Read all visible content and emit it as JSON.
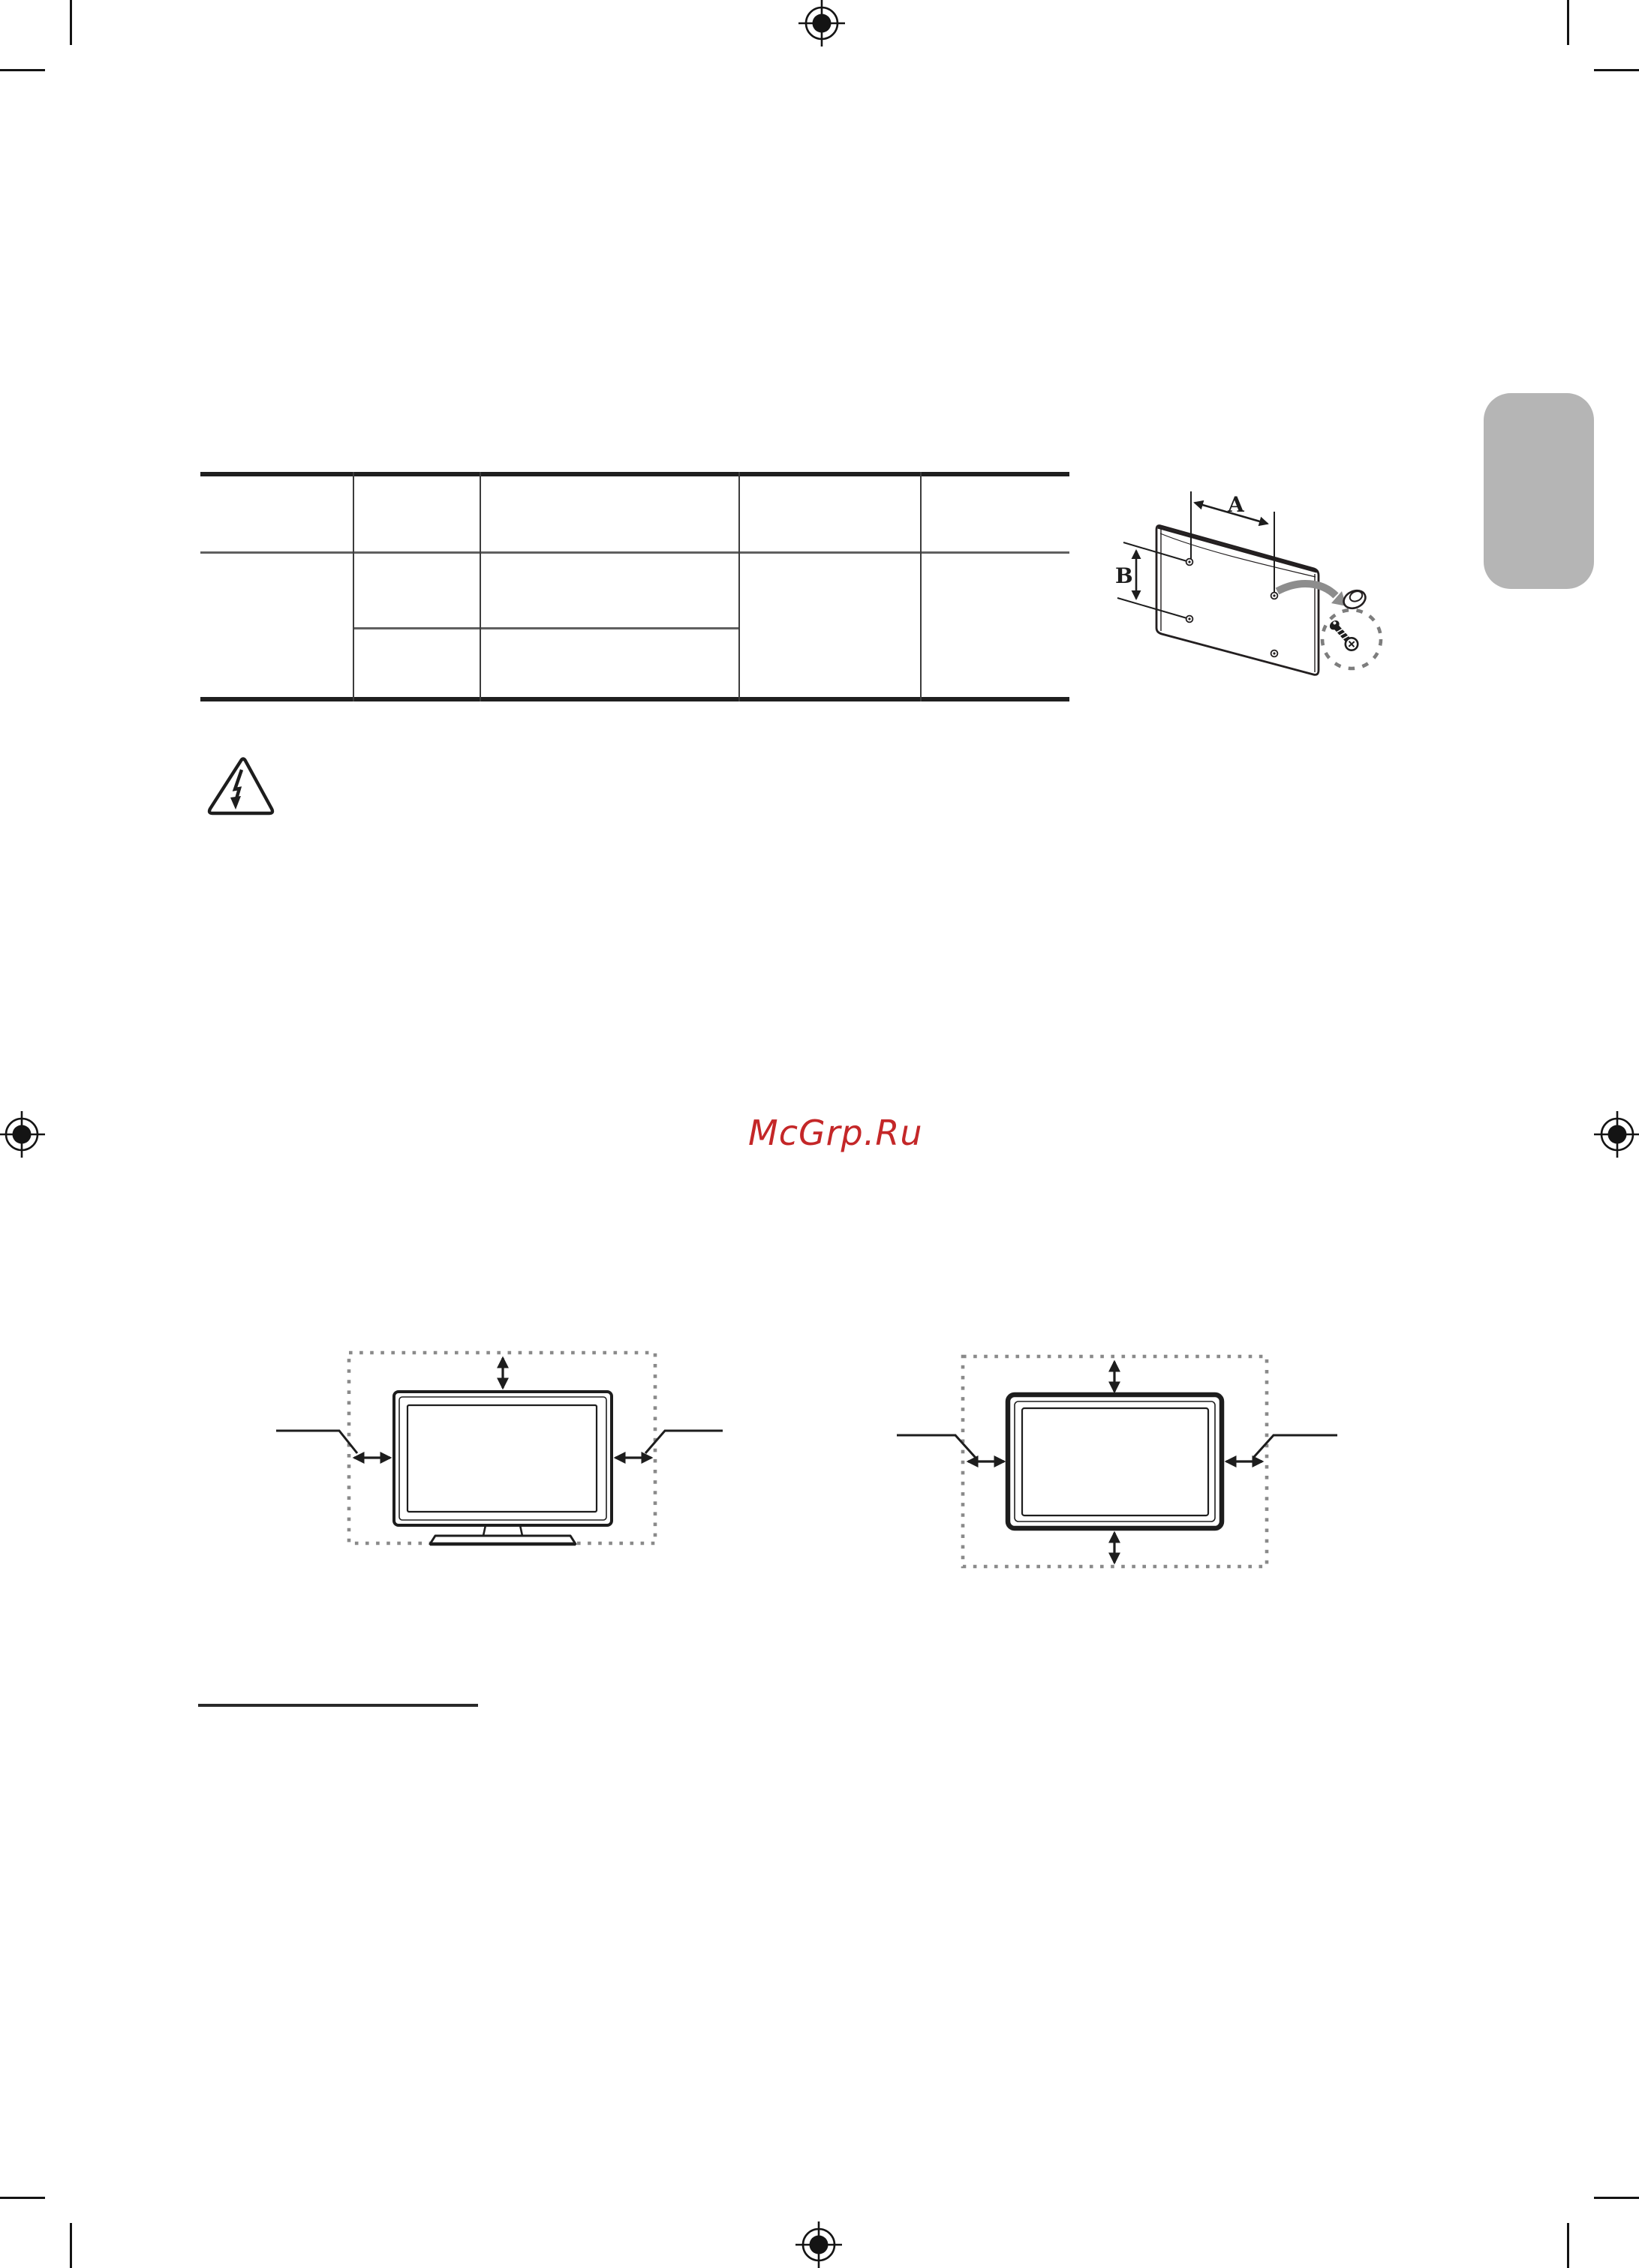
{
  "page": {
    "background": "#ffffff",
    "kind_visible_text_count": 3
  },
  "watermark": {
    "text": "McGrp.Ru",
    "color": "#c42728"
  },
  "wall_mount_diagram": {
    "dimension_a_label": "A",
    "dimension_b_label": "B"
  },
  "mounting_spec_table": {
    "rows": 3,
    "columns": 5,
    "visible_cell_text": []
  },
  "colors": {
    "line_black": "#231f20",
    "gray_arrow": "#8d8d8d",
    "dotted_gray": "#8a8a8a",
    "side_tab_gray": "#b5b5b5",
    "table_gray_rule": "#606060",
    "watermark_red": "#c42728"
  }
}
